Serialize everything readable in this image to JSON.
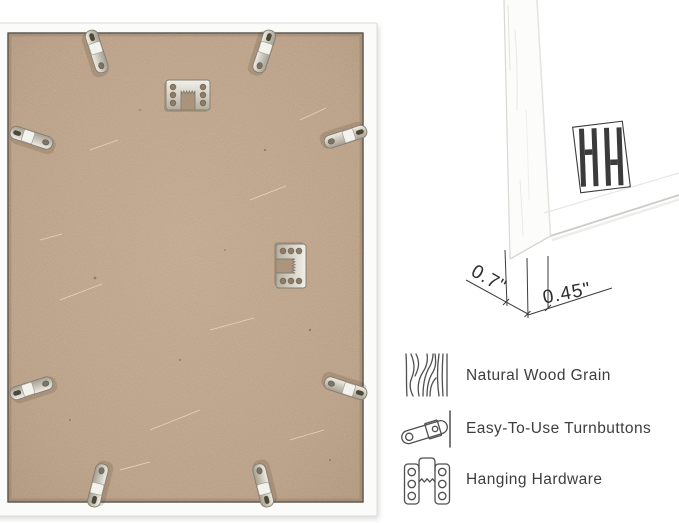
{
  "canvas": {
    "width": 679,
    "height": 523
  },
  "colors": {
    "background": "#ffffff",
    "frame_white": "#fbfbf9",
    "mdf_backing_tan": "#bea184",
    "metal_silver": "#d9d5cb",
    "dimension_line": "#3c3c3c",
    "label_text": "#3d3d3d",
    "logo_dark": "#3b3b3b"
  },
  "back_photo": {
    "turnbutton_count": 8,
    "hanger_count": 2
  },
  "corner_detail": {
    "depth_label": "0.7\"",
    "face_label": "0.45\"",
    "brand_logo": "double-h-logo"
  },
  "features": [
    {
      "icon": "wood-grain-icon",
      "label": "Natural Wood Grain"
    },
    {
      "icon": "turnbutton-icon",
      "label": "Easy-To-Use Turnbuttons"
    },
    {
      "icon": "hanging-hardware-icon",
      "label": "Hanging Hardware"
    }
  ]
}
